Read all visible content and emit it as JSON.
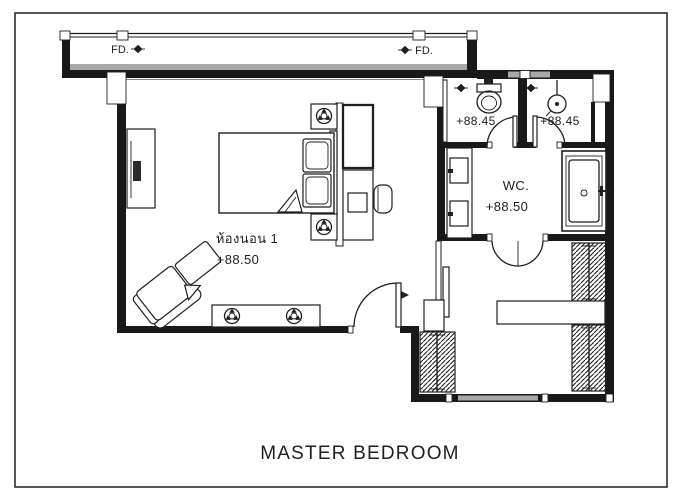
{
  "drawing": {
    "caption": "MASTER BEDROOM",
    "rooms": {
      "bedroom": {
        "name": "ห้องนอน 1",
        "level": "+88.50"
      },
      "wc": {
        "name": "WC.",
        "level": "+88.50"
      },
      "toilet": {
        "level": "+88.45"
      },
      "shower": {
        "level": "+88.45"
      }
    },
    "floor_drains": {
      "left": "FD.",
      "right": "FD."
    },
    "colors": {
      "ink": "#1f1f1f",
      "wall": "#191919",
      "wall_gray": "#a8a8a8",
      "paper": "#ffffff"
    },
    "icons": {
      "floor_drain_marker": "solid-diamond-with-horizontal-line",
      "ceiling_lamp": "concentric-circles-with-three-wedges"
    }
  }
}
